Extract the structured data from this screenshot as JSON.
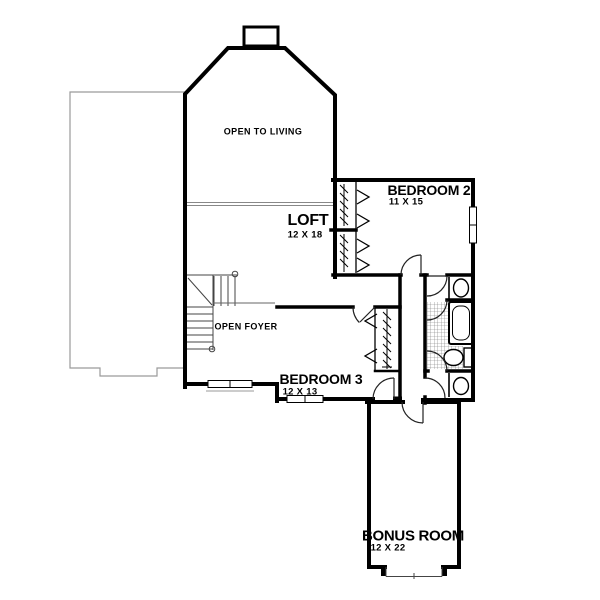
{
  "rooms": {
    "open_to_living": {
      "name": "OPEN TO LIVING"
    },
    "loft": {
      "name": "LOFT",
      "dims": "12 X 18"
    },
    "bedroom2": {
      "name": "BEDROOM 2",
      "dims": "11 X 15"
    },
    "open_foyer": {
      "name": "OPEN FOYER"
    },
    "bedroom3": {
      "name": "BEDROOM 3",
      "dims": "12 X 13"
    },
    "bonus_room": {
      "name": "BONUS ROOM",
      "dims": "12 X 22"
    }
  },
  "fixtures": [
    "staircase",
    "bathtub",
    "toilet",
    "sink-top",
    "sink-bottom",
    "closet-bedroom2",
    "closet-bedroom3",
    "chimney",
    "railing",
    "windows",
    "doors",
    "tile-floor",
    "roof-outline"
  ],
  "colors": {
    "wall": "#000000",
    "background": "#ffffff",
    "roof_line": "#9a9a9a",
    "thin_line": "#444444",
    "tile_line": "#777777"
  }
}
